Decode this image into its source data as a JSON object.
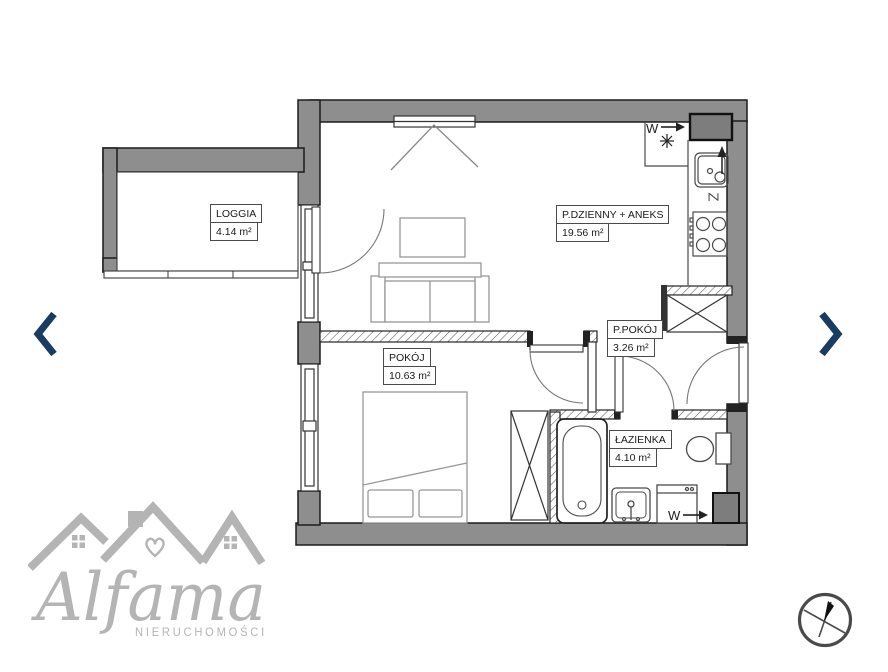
{
  "rooms": {
    "loggia": {
      "name": "LOGGIA",
      "area": "4.14 m²"
    },
    "living": {
      "name": "P.DZIENNY + ANEKS",
      "area": "19.56 m²"
    },
    "bedroom": {
      "name": "POKÓJ",
      "area": "10.63 m²"
    },
    "hall": {
      "name": "P.POKÓJ",
      "area": "3.26 m²"
    },
    "bathroom": {
      "name": "ŁAZIENKA",
      "area": "4.10 m²"
    }
  },
  "plan_annotations": {
    "vent_label": "W",
    "washer_label": "W",
    "kitchen_appliance_label": "Z"
  },
  "logo": {
    "brand": "Alfama",
    "subtitle": "NIERUCHOMOŚCI"
  },
  "colors": {
    "wall_gray": "#8e8e8e",
    "nav_arrow_navy": "#1a3c62",
    "logo_gray": "#b4b4b4"
  }
}
